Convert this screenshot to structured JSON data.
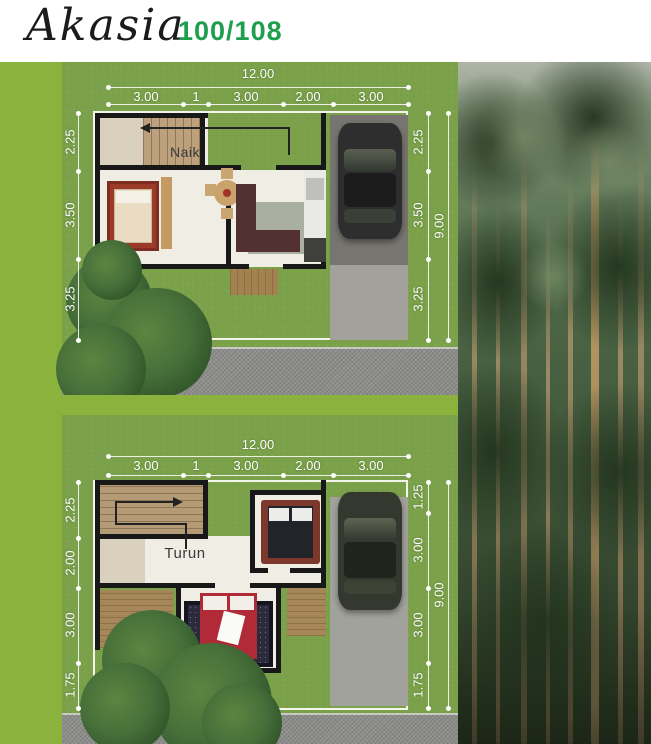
{
  "header": {
    "title": "Akasia",
    "spec": "100/108"
  },
  "colors": {
    "accent_green": "#8cb23e",
    "title_green": "#1f9e4e",
    "grass_green": "#7ba24a",
    "road_gray": "#8d8d8b",
    "wall_black": "#181818"
  },
  "plan_ground": {
    "stair_label": "Naik",
    "width_total": "12.00",
    "width_segments": [
      "3.00",
      "1",
      "3.00",
      "2.00",
      "3.00"
    ],
    "left_segments": [
      "2.25",
      "3.50",
      "3.25"
    ],
    "right_segments": [
      "2.25",
      "3.50",
      "3.25"
    ],
    "height_total": "9.00"
  },
  "plan_upper": {
    "stair_label": "Turun",
    "width_total": "12.00",
    "width_segments": [
      "3.00",
      "1",
      "3.00",
      "2.00",
      "3.00"
    ],
    "left_segments": [
      "2.25",
      "2.00",
      "3.00",
      "1.75"
    ],
    "right_segments": [
      "1.25",
      "3.00",
      "3.00",
      "1.75"
    ],
    "height_total": "9.00"
  }
}
